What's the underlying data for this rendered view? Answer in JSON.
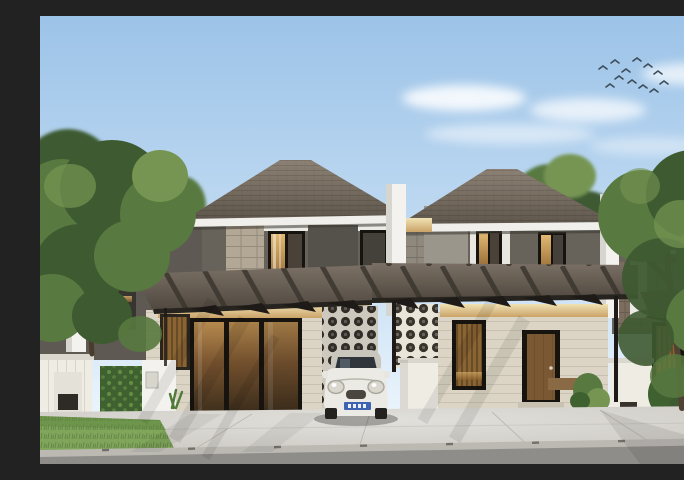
{
  "image": {
    "kind": "3d-architectural-exterior-visualization",
    "width_px": 684,
    "height_px": 448
  },
  "scene": {
    "summary": "Daytime rendering of a row of modern minimalist two-storey terrace houses with grey hip roofs, dark steel carport pergolas, circular breeze-block screen walls, cream ground-floor facades, white fence pillars, hedges and lawns; a white compact hatchback is parked in the centre carport; large green trees frame both sides and a small flock of birds flies in the blue sky",
    "sky": {
      "condition": "clear blue with thin white clouds",
      "bird_count": 12
    },
    "houses": {
      "fully_visible": 2,
      "partially_visible": 2,
      "storeys": 2,
      "roof_style": "hip, dark grey shingles with white fascia",
      "carport": "flat dark pergola with exposed black rafter tips and slim posts"
    },
    "vehicle": {
      "type": "compact hatchback, Mini-style, front view",
      "color": "white",
      "license_plate": "blue plate, characters illegible"
    },
    "landscaping": [
      "large leafy tree left foreground",
      "leafy tree right foreground",
      "pine and broadleaf trees in background",
      "vertical-garden hedge panel at left fence",
      "clipped hedge and shrubs at right",
      "lawn strips beside concrete driveway"
    ],
    "ground": "light concrete driveway apron, grey curb, asphalt street strip"
  },
  "palette": {
    "sky_top": "#9cc3e8",
    "sky_mid": "#c6def3",
    "sky_low": "#e7f2fb",
    "cloud_white": "#ffffff",
    "bird": "#3c4c5a",
    "leaf_dark": "#3e5a31",
    "leaf_mid": "#58793f",
    "leaf_light": "#769552",
    "trunk": "#56452f",
    "roof_main": "#756b5f",
    "roof_light": "#8c8174",
    "roof_shadow": "#5c544a",
    "fascia_white": "#f0efeb",
    "eave_shadow": "#3b3731",
    "wall_dark": "#67635b",
    "wall_panel": "#55524b",
    "wall_wing": "#5e5a53",
    "stone": "#b3a795",
    "stone_gray": "#8f887c",
    "trim_white": "#ecebe5",
    "pillar_white": "#f3f2ee",
    "pillar_shade": "#d7d5cf",
    "canopy_top": "#7a7065",
    "canopy_deep": "#4e463e",
    "canopy_front": "#27241f",
    "beam_black": "#1d1a17",
    "rafter": "#3a352e",
    "soffit_hi": "#f0e2b4",
    "soffit_lo": "#caa368",
    "glow_hi": "#e2b873",
    "glow_lo": "#8a5f2c",
    "facade_cream": "#dcd5c5",
    "frame_black": "#17140f",
    "wood": "#7a5833",
    "louver": "#8a6433",
    "breeze_bg": "#eae5d9",
    "breeze_hole": "#38342c",
    "hedge_dark": "#3f6130",
    "hedge_leaf": "#6a9448",
    "white_wall": "#efece4",
    "vent_dark": "#37332c",
    "grass": "#7fa65a",
    "grass_dark": "#5e8640",
    "drive": "#cbc8c2",
    "drive_light": "#e2e0db",
    "road": "#8f8d89",
    "curb": "#bcb9b3",
    "car_body": "#eceae4",
    "car_shade": "#c9c6bd",
    "car_glass": "#30353b",
    "plate_blue": "#3e63b0",
    "wheel": "#24221f",
    "shadow": "#000000"
  }
}
